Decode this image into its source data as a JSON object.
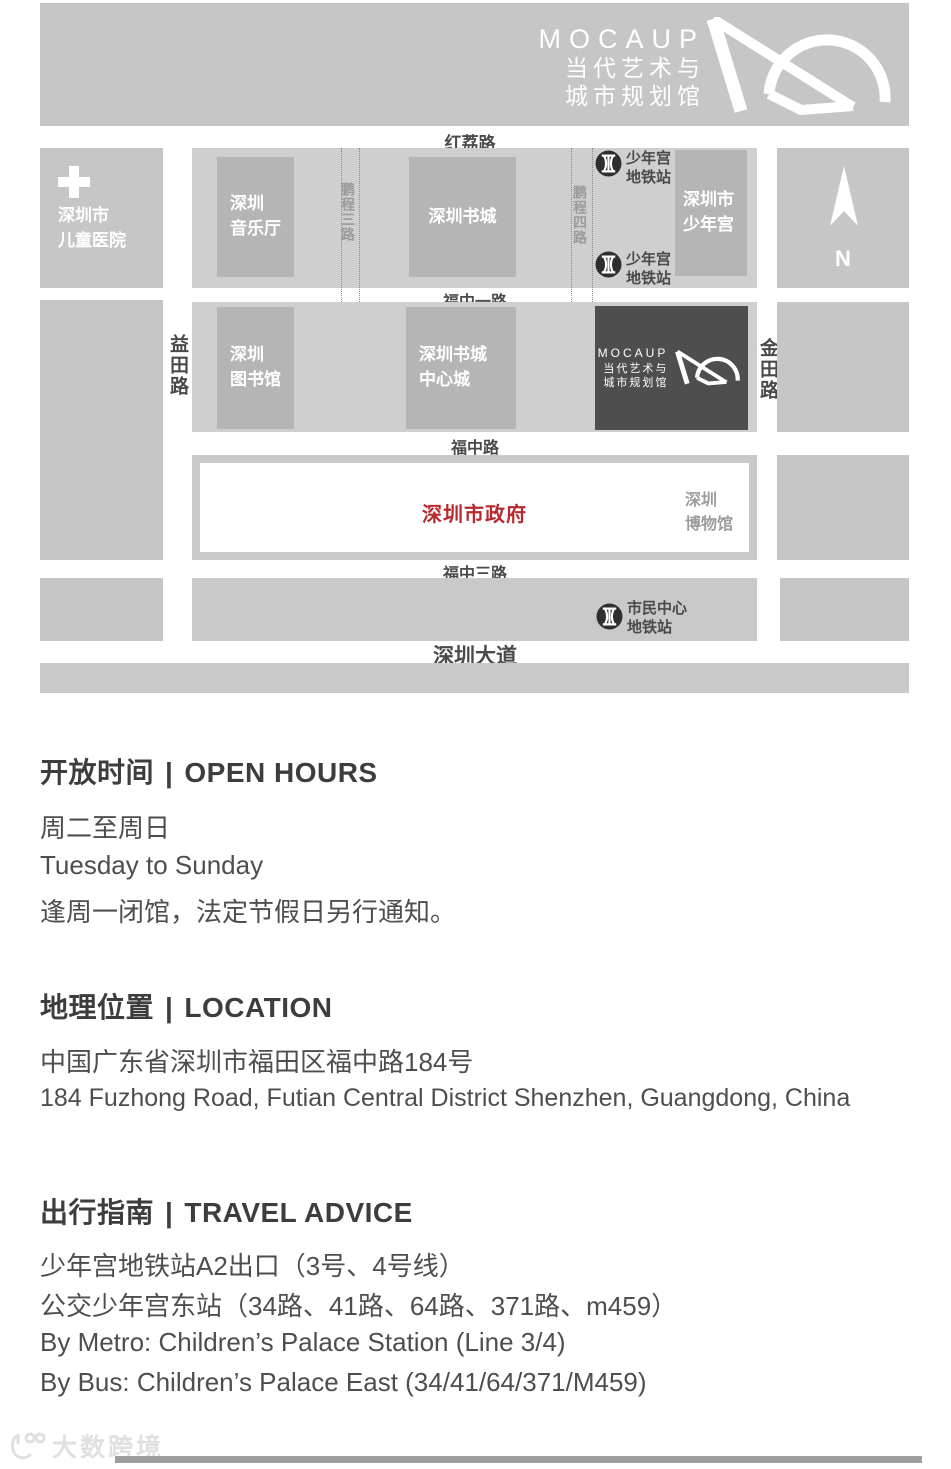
{
  "colors": {
    "band_gray": "#c6c6c6",
    "container_gray": "#cfcfcf",
    "building_gray": "#b5b5b5",
    "mocaup_dark": "#4e4e4e",
    "government_red": "#b6292d",
    "road_label": "#4a4a4a",
    "metro_dark": "#2e2e2e",
    "watermark_gray": "#e0e0e0"
  },
  "header": {
    "logo": {
      "line1": "MOCAUP",
      "line2": "当代艺术与",
      "line3": "城市规划馆"
    }
  },
  "map": {
    "roads": {
      "honglilu": "红荔路",
      "fuzhongyilu": "福中一路",
      "fuzhonglu": "福中路",
      "fuzhongsanlu": "福中三路",
      "shenzhendadao": "深圳大道",
      "yitianlu": "益田路",
      "jintianlu": "金田路",
      "pengchengsanlu": "鹏程三路",
      "pengchengsilu": "鹏程四路"
    },
    "places": {
      "hospital": {
        "line1": "深圳市",
        "line2": "儿童医院"
      },
      "concert_hall": {
        "line1": "深圳",
        "line2": "音乐厅"
      },
      "book_city": {
        "line1": "深圳书城"
      },
      "children_palace": {
        "line1": "深圳市",
        "line2": "少年宫"
      },
      "library": {
        "line1": "深圳",
        "line2": "图书馆"
      },
      "book_city_central": {
        "line1": "深圳书城",
        "line2": "中心城"
      },
      "museum": {
        "line1": "深圳",
        "line2": "博物馆"
      },
      "government": "深圳市政府",
      "mocaup": {
        "line1": "MOCAUP",
        "line2": "当代艺术与",
        "line3": "城市规划馆"
      }
    },
    "metro": {
      "children_palace": {
        "line1": "少年宫",
        "line2": "地铁站"
      },
      "civic_center": {
        "line1": "市民中心",
        "line2": "地铁站"
      }
    },
    "compass_n": "N"
  },
  "sections": {
    "divider": "|",
    "open_hours": {
      "title_zh": "开放时间",
      "title_en": "OPEN HOURS",
      "line1": "周二至周日",
      "line2": "Tuesday to Sunday",
      "line3": "逢周一闭馆，法定节假日另行通知。"
    },
    "location": {
      "title_zh": "地理位置",
      "title_en": "LOCATION",
      "line1": "中国广东省深圳市福田区福中路184号",
      "line2": "184 Fuzhong Road, Futian Central District Shenzhen, Guangdong, China"
    },
    "travel": {
      "title_zh": "出行指南",
      "title_en": "TRAVEL ADVICE",
      "line1": "少年宫地铁站A2出口（3号、4号线）",
      "line2": "公交少年宫东站（34路、41路、64路、371路、m459）",
      "line3": "By Metro: Children’s Palace Station (Line 3/4)",
      "line4": "By Bus: Children’s Palace East (34/41/64/371/M459)"
    }
  },
  "footer": {
    "watermark": "大数跨境"
  }
}
